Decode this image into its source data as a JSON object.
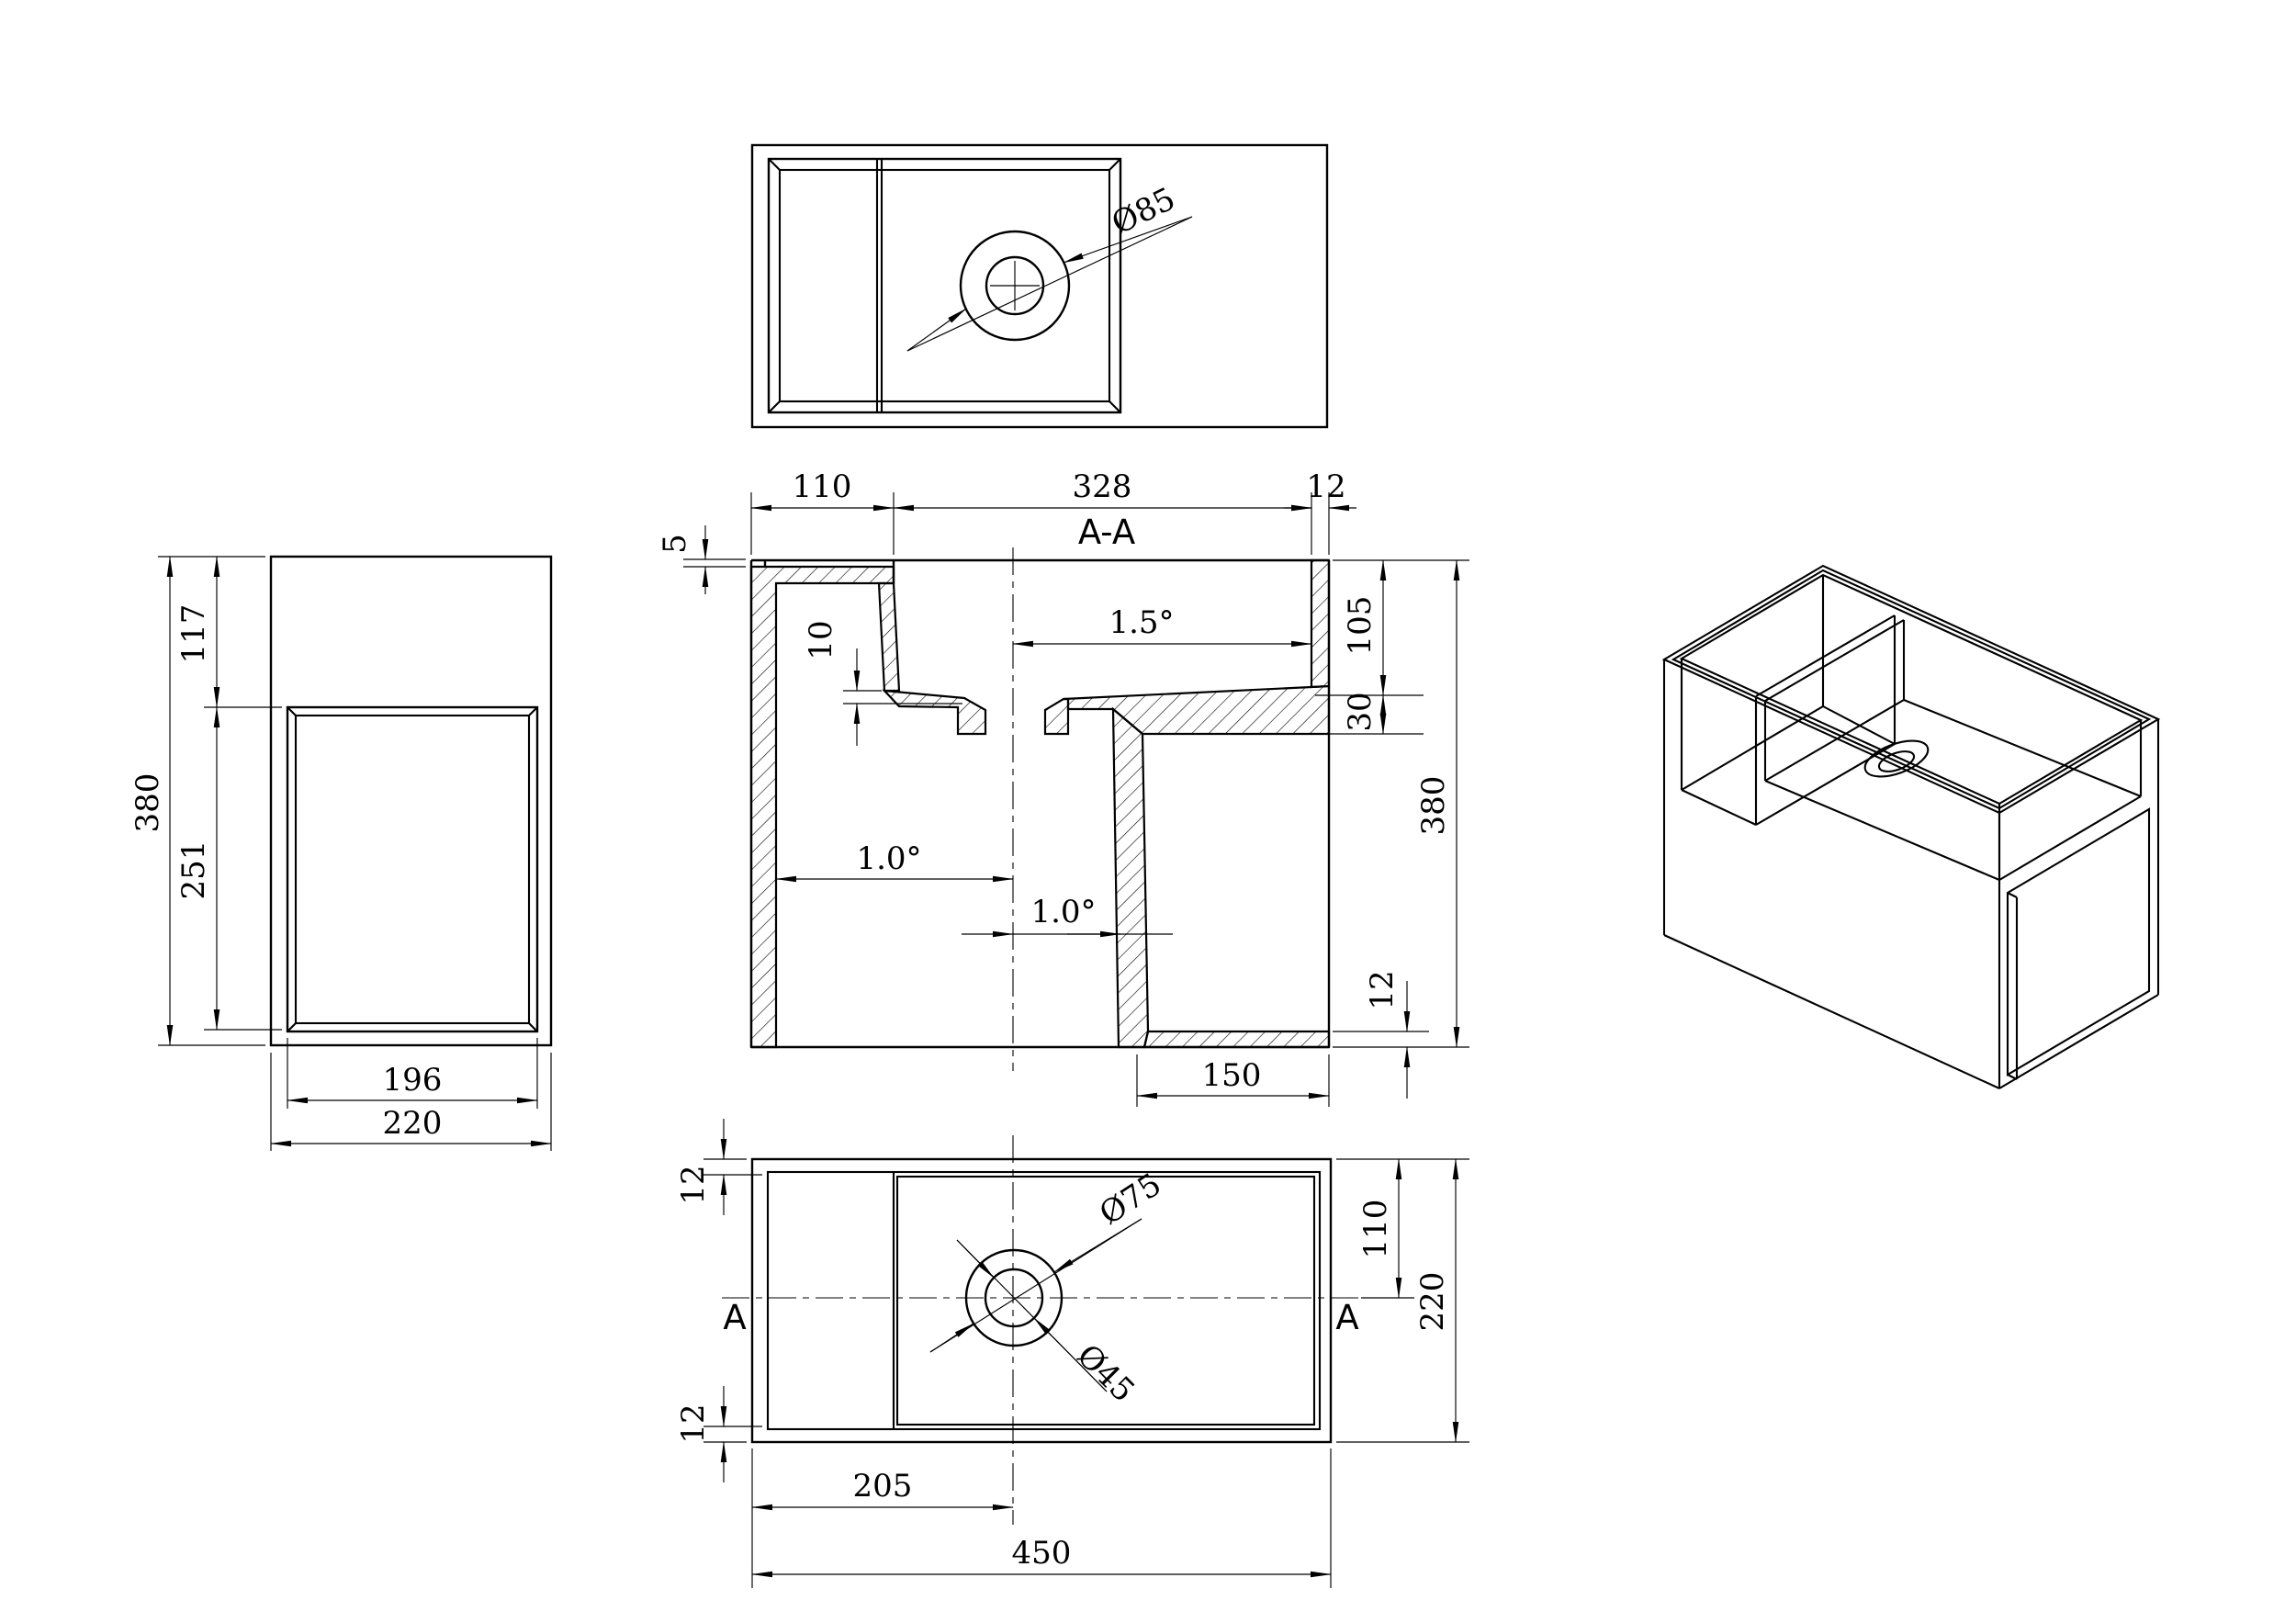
{
  "views": {
    "underside": {
      "drain_diameter": "Ø85"
    },
    "section": {
      "label": "A-A",
      "step_dim": "5",
      "top_dims": [
        "110",
        "328",
        "12"
      ],
      "slope_basin": "1.5°",
      "drop_dim": "10",
      "draft_left": "1.0°",
      "draft_mid": "1.0°",
      "right_dims": [
        "105",
        "30",
        "380",
        "12"
      ],
      "opening_width": "150"
    },
    "side": {
      "seg_top": "117",
      "seg_opening": "251",
      "height": "380",
      "opening_width": "196",
      "width": "220"
    },
    "plan": {
      "rim_top": "12",
      "rim_bottom": "12",
      "half_depth": "110",
      "depth": "220",
      "drain_offset": "205",
      "length": "450",
      "drain_outer": "Ø75",
      "drain_inner": "Ø45",
      "cut_marker_left": "A",
      "cut_marker_right": "A"
    }
  }
}
